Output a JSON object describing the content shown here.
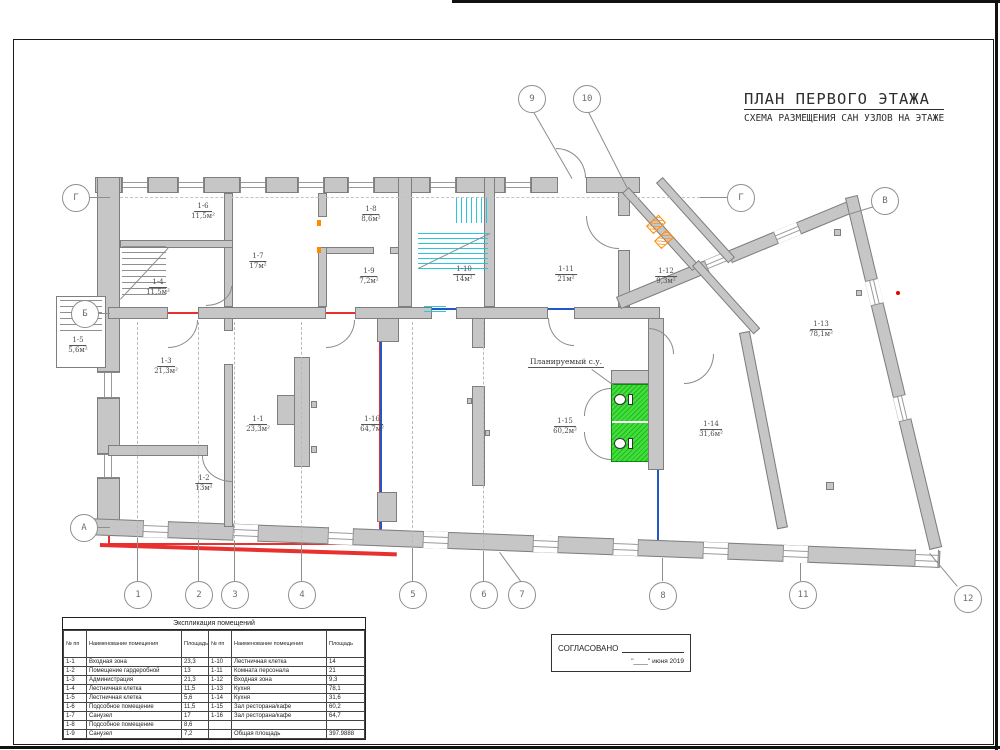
{
  "title": {
    "main": "ПЛАН ПЕРВОГО ЭТАЖА",
    "subtitle": "СХЕМА РАЗМЕЩЕНИЯ САН УЗЛОВ НА ЭТАЖЕ"
  },
  "plan": {
    "planned_su_label": "Планируемый с.у.",
    "colors": {
      "red": "#e8312e",
      "blue": "#2257c5",
      "green": "#3fe03a",
      "wall": "#c6c6c6",
      "cyan": "#27c8dc",
      "orange": "#ff8a00"
    },
    "rooms": [
      {
        "num": "1-6",
        "area": "11,5м²",
        "x": 203,
        "y": 212
      },
      {
        "num": "1-4",
        "area": "11,5м²",
        "x": 158,
        "y": 288
      },
      {
        "num": "1-7",
        "area": "17м²",
        "x": 258,
        "y": 262
      },
      {
        "num": "1-8",
        "area": "8,6м²",
        "x": 371,
        "y": 215
      },
      {
        "num": "1-9",
        "area": "7,2м²",
        "x": 369,
        "y": 277
      },
      {
        "num": "1-10",
        "area": "14м²",
        "x": 464,
        "y": 275
      },
      {
        "num": "1-11",
        "area": "21м²",
        "x": 566,
        "y": 275
      },
      {
        "num": "1-12",
        "area": "9,3м²",
        "x": 666,
        "y": 277
      },
      {
        "num": "1-5",
        "area": "5,6м²",
        "x": 78,
        "y": 346
      },
      {
        "num": "1-3",
        "area": "21,3м²",
        "x": 166,
        "y": 367
      },
      {
        "num": "1-1",
        "area": "23,3м²",
        "x": 258,
        "y": 425
      },
      {
        "num": "1-2",
        "area": "13м²",
        "x": 204,
        "y": 484
      },
      {
        "num": "1-16",
        "area": "64,7м²",
        "x": 372,
        "y": 425
      },
      {
        "num": "1-15",
        "area": "60,2м²",
        "x": 565,
        "y": 427
      },
      {
        "num": "1-14",
        "area": "31,6м²",
        "x": 711,
        "y": 430
      },
      {
        "num": "1-13",
        "area": "78,1м²",
        "x": 821,
        "y": 330
      }
    ],
    "grid_bubbles": [
      {
        "label": "9",
        "x": 531,
        "y": 98
      },
      {
        "label": "10",
        "x": 586,
        "y": 98
      },
      {
        "label": "Г",
        "x": 75,
        "y": 197
      },
      {
        "label": "Г",
        "x": 740,
        "y": 197
      },
      {
        "label": "В",
        "x": 884,
        "y": 200
      },
      {
        "label": "Б",
        "x": 84,
        "y": 313
      },
      {
        "label": "А",
        "x": 83,
        "y": 527
      },
      {
        "label": "1",
        "x": 137,
        "y": 594
      },
      {
        "label": "2",
        "x": 198,
        "y": 594
      },
      {
        "label": "3",
        "x": 234,
        "y": 594
      },
      {
        "label": "4",
        "x": 301,
        "y": 594
      },
      {
        "label": "5",
        "x": 412,
        "y": 594
      },
      {
        "label": "6",
        "x": 483,
        "y": 594
      },
      {
        "label": "7",
        "x": 521,
        "y": 594
      },
      {
        "label": "8",
        "x": 662,
        "y": 595
      },
      {
        "label": "11",
        "x": 802,
        "y": 594
      },
      {
        "label": "12",
        "x": 967,
        "y": 598
      }
    ]
  },
  "explication_table": {
    "title": "Экспликация помещений",
    "headers": [
      "№ пп",
      "Наименование помещения",
      "Площадь",
      "№ пп",
      "Наименование помещения",
      "Площадь"
    ],
    "rows": [
      [
        "1-1",
        "Входная зона",
        "23,3",
        "1-10",
        "Лестничная клетка",
        "14"
      ],
      [
        "1-2",
        "Помещение гардеробной",
        "13",
        "1-11",
        "Комната персонала",
        "21"
      ],
      [
        "1-3",
        "Администрация",
        "21,3",
        "1-12",
        "Входная зона",
        "9,3"
      ],
      [
        "1-4",
        "Лестничная клетка",
        "11,5",
        "1-13",
        "Кухня",
        "78,1"
      ],
      [
        "1-5",
        "Лестничная клетка",
        "5,6",
        "1-14",
        "Кухня",
        "31,6"
      ],
      [
        "1-6",
        "Подсобное помещение",
        "11,5",
        "1-15",
        "Зал ресторана/кафе",
        "60,2"
      ],
      [
        "1-7",
        "Санузел",
        "17",
        "1-16",
        "Зал ресторана/кафе",
        "64,7"
      ],
      [
        "1-8",
        "Подсобное помещение",
        "8,6",
        "",
        "",
        ""
      ],
      [
        "1-9",
        "Санузел",
        "7,2",
        "",
        "Общая площадь",
        "397.9888"
      ]
    ]
  },
  "approval": {
    "label": "СОГЛАСОВАНО",
    "date_line": "\"____\" июня 2019"
  }
}
